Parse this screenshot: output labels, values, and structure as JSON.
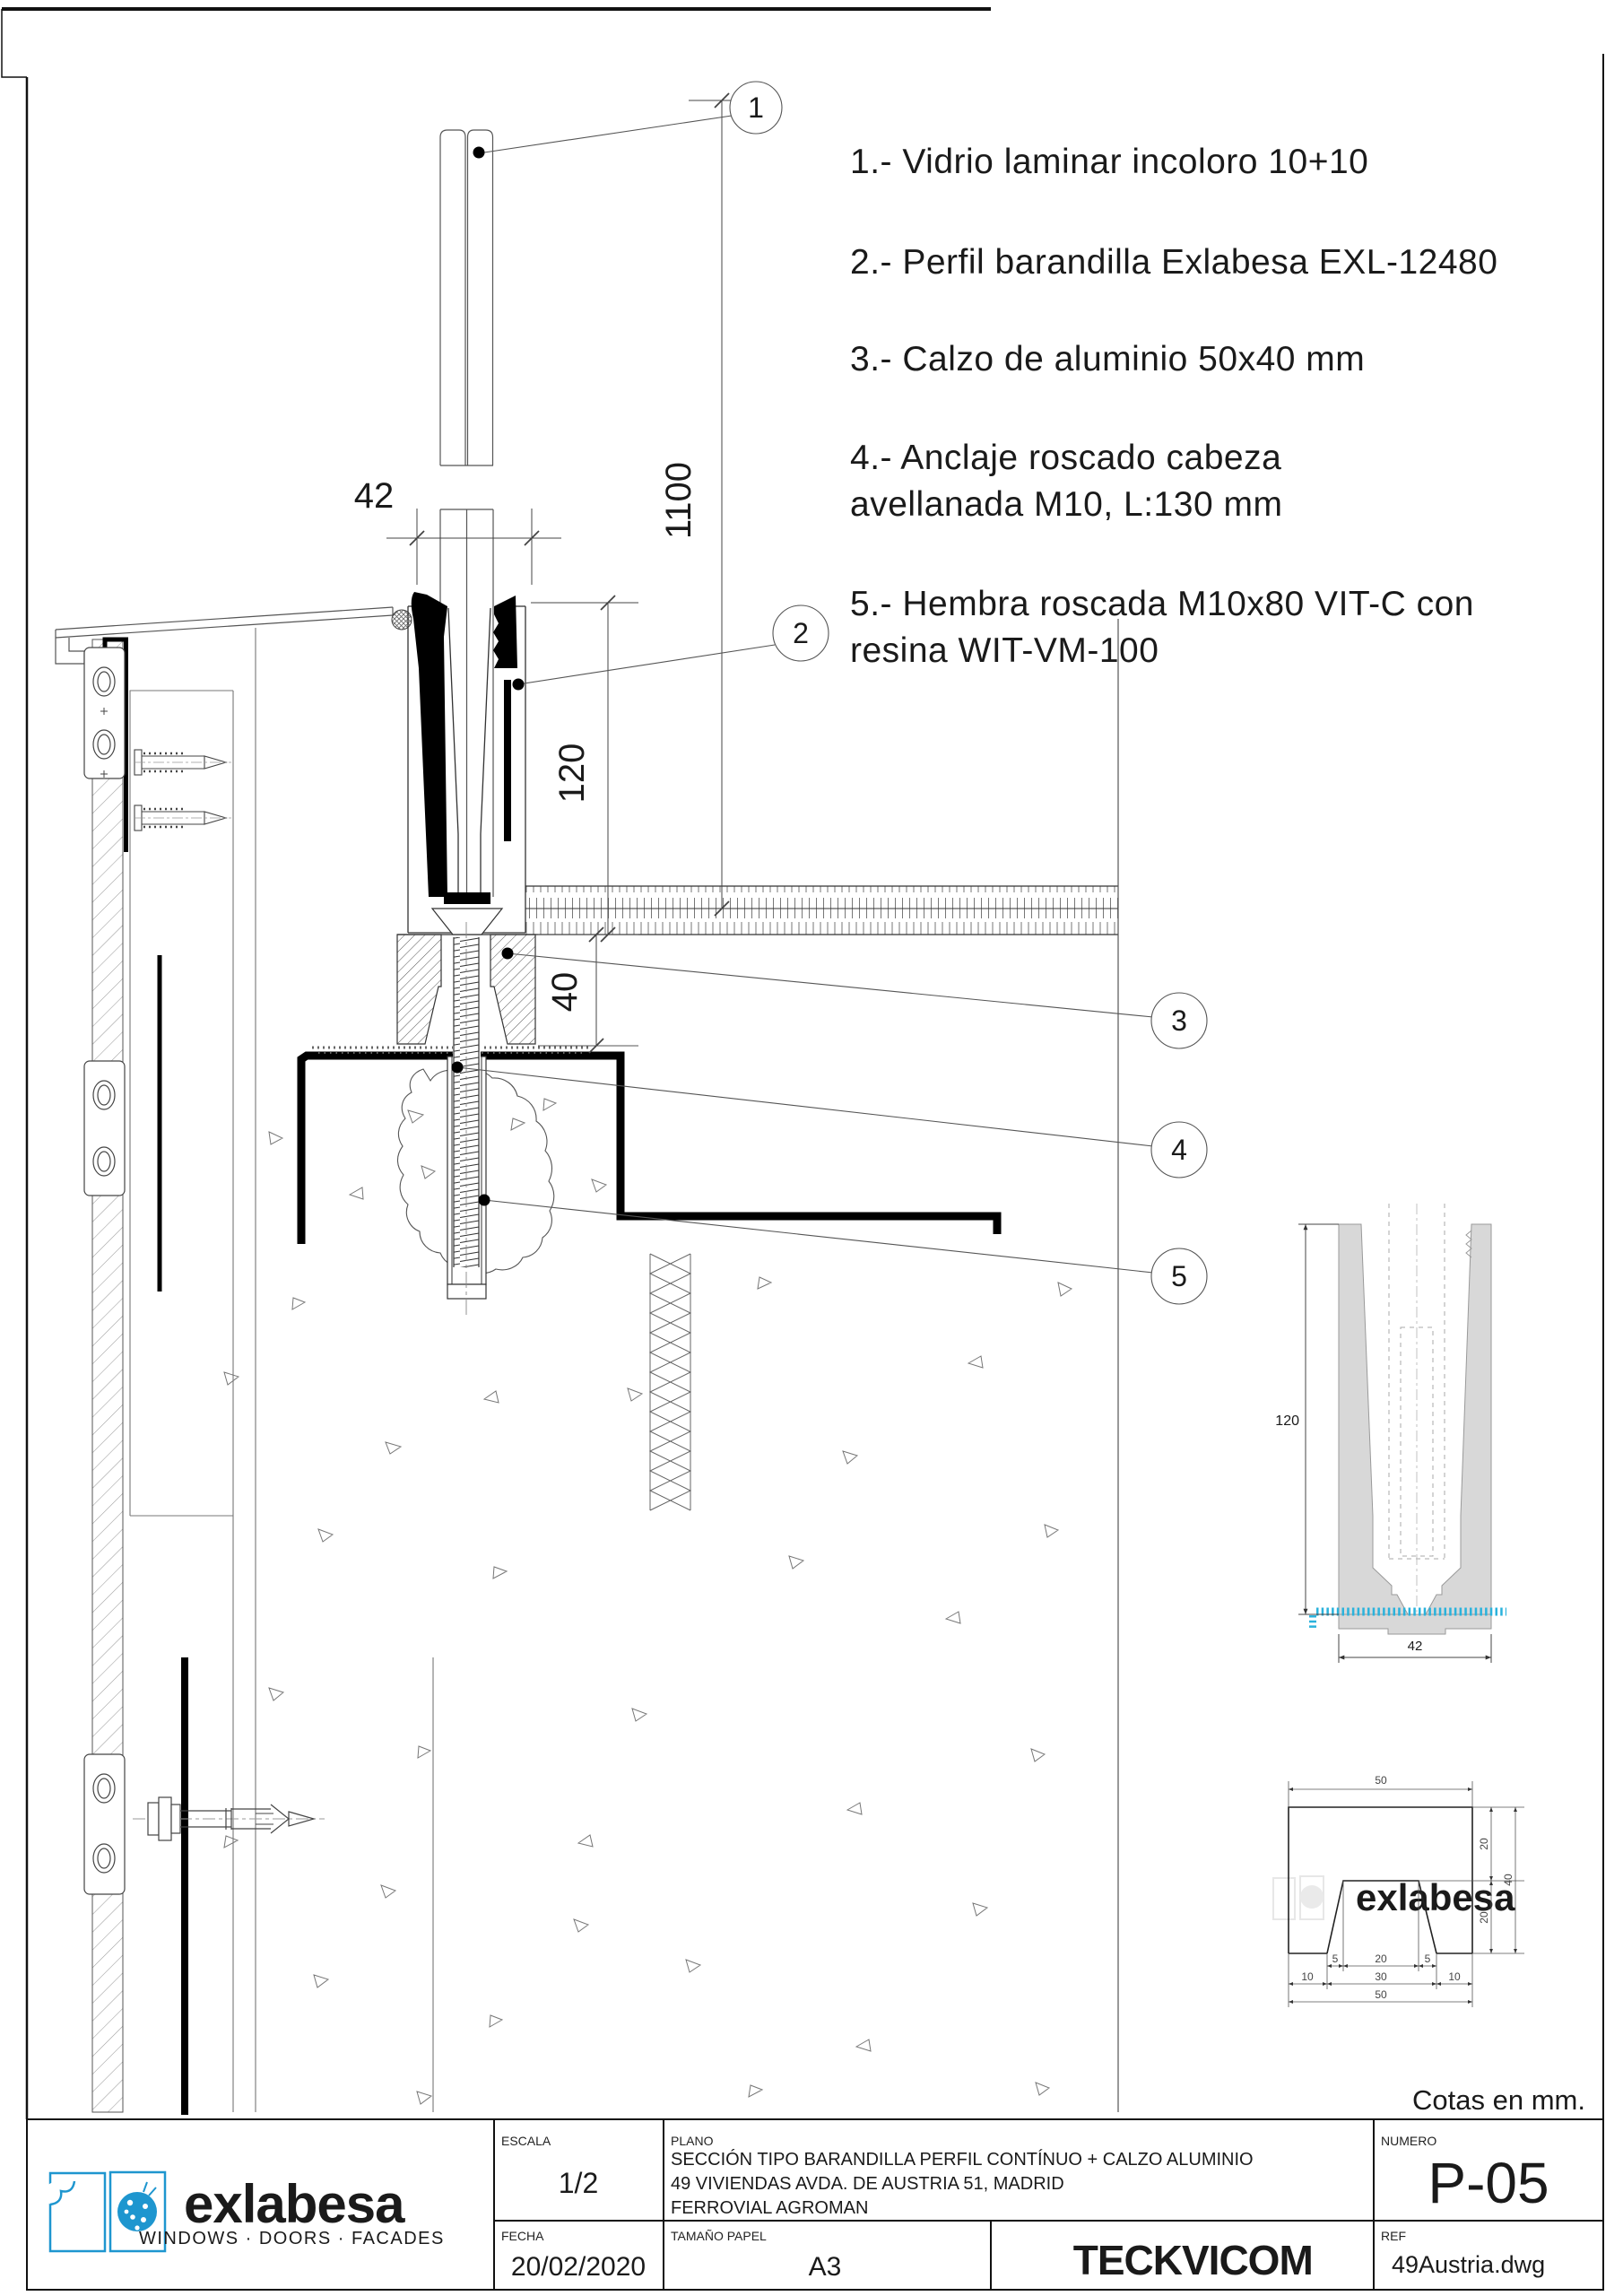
{
  "colors": {
    "brand_blue": "#1e96cf",
    "teck_gray": "#8d8d8d",
    "vicom_blue": "#2aa8dc",
    "detail_cyan": "#2ab2dc"
  },
  "notes": [
    {
      "line1": "1.- Vidrio laminar incoloro 10+10"
    },
    {
      "line1": "2.- Perfil barandilla Exlabesa EXL-12480"
    },
    {
      "line1": "3.- Calzo de  aluminio 50x40 mm"
    },
    {
      "line1": "4.- Anclaje roscado cabeza",
      "line2": "avellanada M10, L:130 mm"
    },
    {
      "line1": "5.- Hembra roscada M10x80 VIT-C con",
      "line2": "resina WIT-VM-100"
    }
  ],
  "callouts": {
    "c1": "1",
    "c2": "2",
    "c3": "3",
    "c4": "4",
    "c5": "5"
  },
  "dims": {
    "glass_width": "42",
    "railing_height": "1100",
    "profile_height": "120",
    "calzo_height": "40"
  },
  "units_note": "Cotas en mm.",
  "profile_detail": {
    "height": "120",
    "width": "42"
  },
  "calzo_detail": {
    "top_width": "50",
    "side_upper": "20",
    "side_total": "40",
    "side_lower": "20",
    "notch_bottom_left": "5",
    "notch_top": "20",
    "notch_bottom_right": "5",
    "base_left": "10",
    "base_middle": "30",
    "base_right": "10",
    "bottom_width": "50",
    "watermark": "exlabesa"
  },
  "titleblock": {
    "brand": "exlabesa",
    "brand_tagline": "WINDOWS · DOORS · FACADES",
    "escala_label": "ESCALA",
    "escala_value": "1/2",
    "plano_label": "PLANO",
    "plano_line1": "SECCIÓN TIPO BARANDILLA PERFIL CONTÍNUO + CALZO ALUMINIO",
    "plano_line2": "49 VIVIENDAS AVDA. DE AUSTRIA 51, MADRID",
    "plano_line3": "FERROVIAL AGROMAN",
    "numero_label": "NUMERO",
    "numero_value": "P-05",
    "fecha_label": "FECHA",
    "fecha_value": "20/02/2020",
    "tamano_label": "TAMAÑO PAPEL",
    "tamano_value": "A3",
    "logo_teck": "TECK",
    "logo_vicom": "VICOM",
    "ref_label": "REF",
    "ref_value": "49Austria.dwg"
  }
}
